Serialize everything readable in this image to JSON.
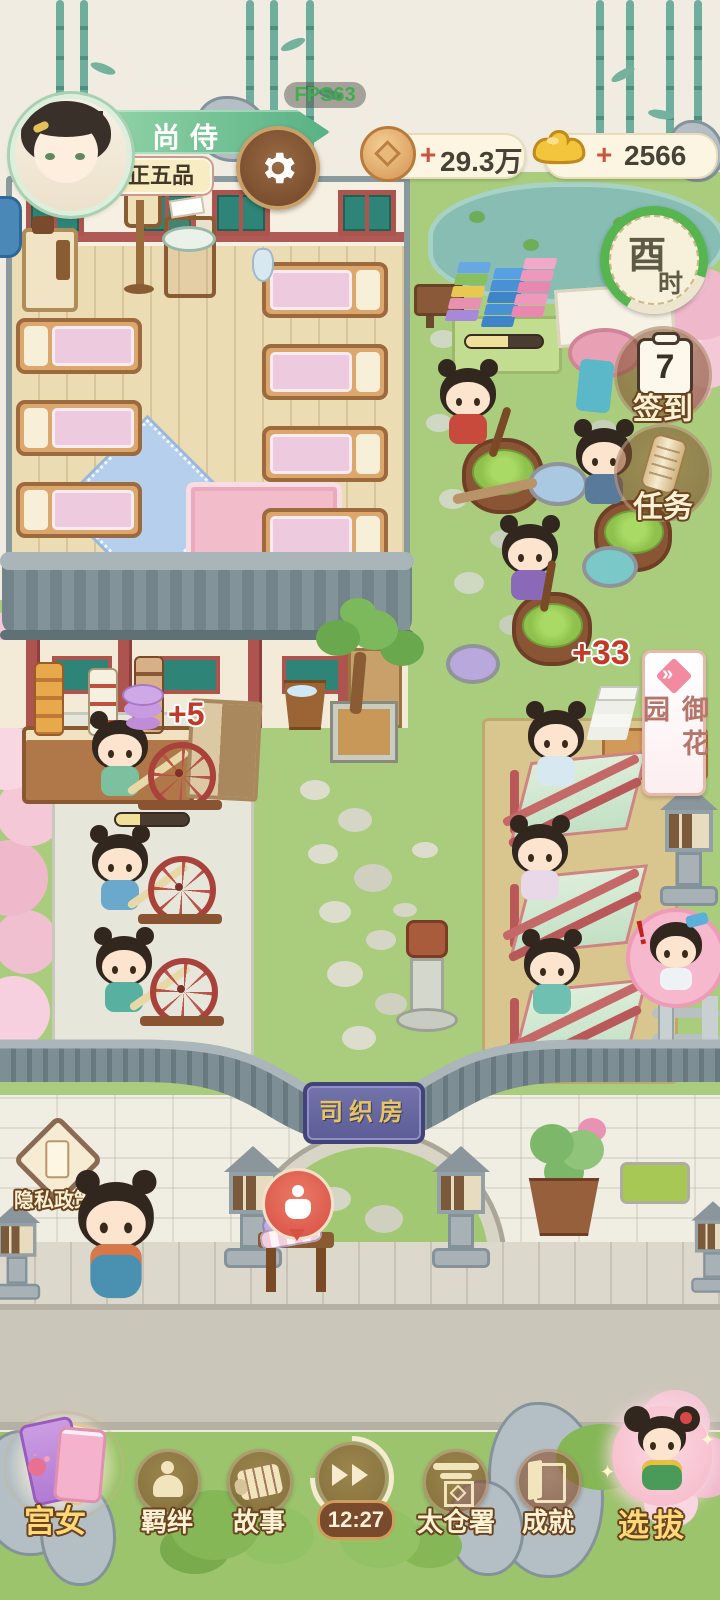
{
  "hud": {
    "fps": "FPS63",
    "player": {
      "name": "尚侍",
      "rank": "正五品"
    },
    "currencies": {
      "coins": {
        "plus": "+",
        "value": "29.3万"
      },
      "ingots": {
        "plus": "+",
        "value": "2566"
      }
    },
    "time_badge": {
      "char1": "酉",
      "char2": "时"
    },
    "signin": {
      "day": "7",
      "label": "签到"
    },
    "tasks": {
      "label": "任务"
    },
    "garden_banner": {
      "chevrons": "»",
      "label": "御花园"
    }
  },
  "scene": {
    "float_spinning": "+5",
    "float_dyeing": "+33",
    "gate_plaque": "司织房",
    "npc_alert": "!",
    "privacy_label": "隐私政策"
  },
  "nav": {
    "gongnv": "宫女",
    "jiban": "羁绊",
    "gushi": "故事",
    "timer": "12:27",
    "taicang": "太仓署",
    "chengjiu": "成就",
    "xuanba": "选拔"
  },
  "colors": {
    "accent_red": "#c13b2a",
    "banner_green": "#58b184",
    "gold_ingot": "#f2c53d",
    "grass": "#a9cd7d"
  }
}
